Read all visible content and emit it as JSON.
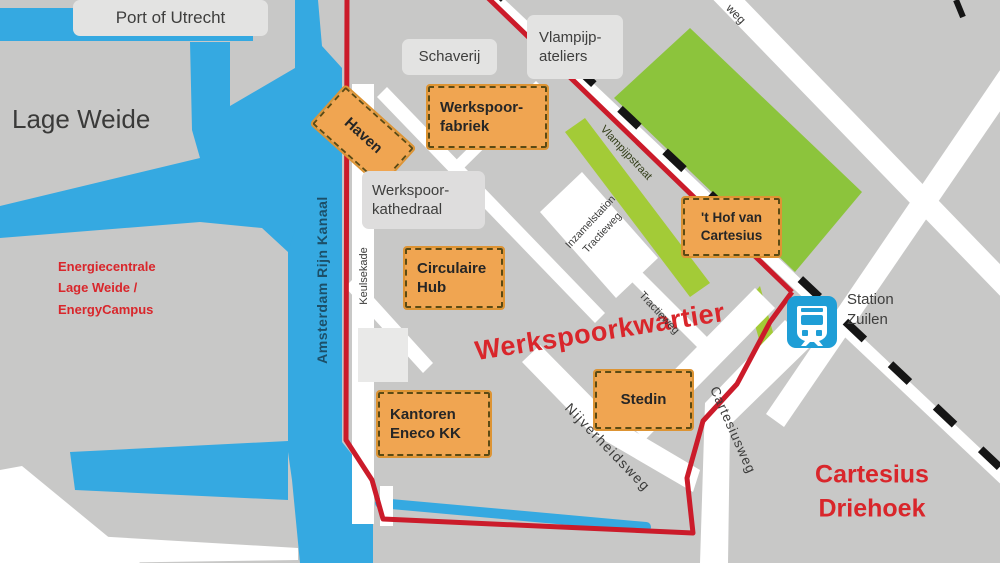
{
  "map": {
    "areas": {
      "port_of_utrecht": "Port of Utrecht",
      "lage_weide": "Lage Weide",
      "energiecentrale": "Energiecentrale\nLage Weide /\nEnergyCampus",
      "werkspoorkwartier": "Werkspoorkwartier",
      "cartesius_driehoek": "Cartesius\nDriehoek"
    },
    "water_labels": {
      "kanaal": "Amsterdam Rijn Kanaal"
    },
    "streets": {
      "keulsekade": "Keulsekade",
      "vlampijpstraat": "Vlampijpstraat",
      "inzamelstation": "Inzamelstation\nTractieweg",
      "tractieweg": "Tractieweg",
      "nijverheidsweg": "Nijverheidsweg",
      "cartesiusweg": "Cartesiusweg",
      "weg_partial": "weg"
    },
    "sites": {
      "haven": "Haven",
      "werkspoorfabriek": "Werkspoor-\nfabriek",
      "circulaire_hub": "Circulaire\nHub",
      "kantoren_eneco": "Kantoren\nEneco KK",
      "stedin": "Stedin",
      "hof_van_cartesius": "'t Hof van\nCartesius"
    },
    "buildings": {
      "schaverij": "Schaverij",
      "vlampijp_ateliers": "Vlampijp-\nateliers",
      "werkspoorkathedraal": "Werkspoor-\nkathedraal"
    },
    "station": {
      "label": "Station\nZuilen"
    },
    "colors": {
      "water": "#35a9e1",
      "land": "#c8c8c7",
      "park": "#8cc43c",
      "road": "#ffffff",
      "boundary_red": "#cb1b2a",
      "site_orange": "#f0a551",
      "label_gray": "#e3e3e2",
      "red_text": "#d9262b",
      "station_blue": "#1f9ed6"
    }
  }
}
